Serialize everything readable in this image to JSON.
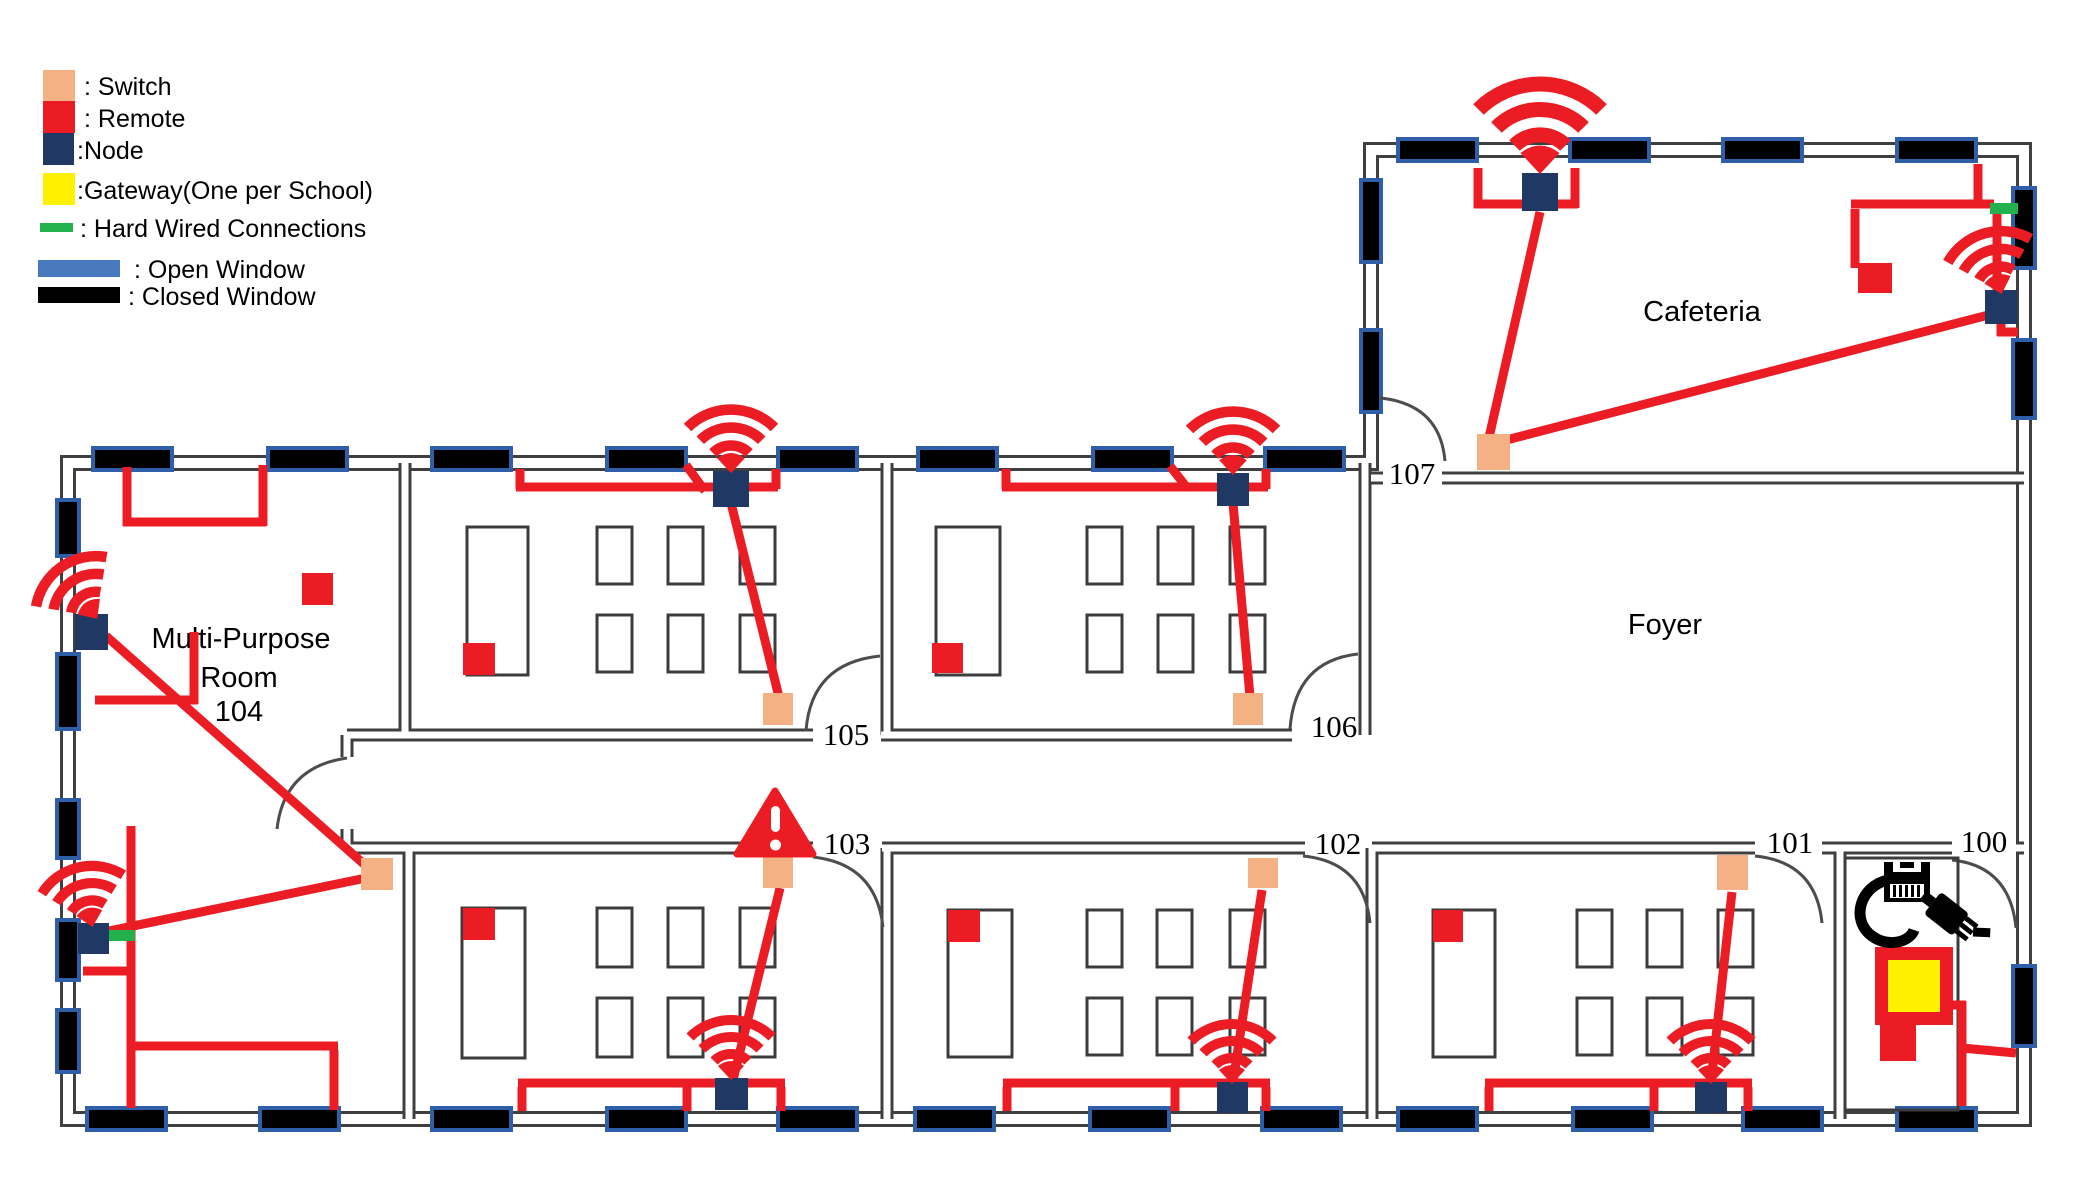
{
  "legend": {
    "switch_label": ": Switch",
    "remote_label": ": Remote",
    "node_label": ":Node",
    "gateway_label": ":Gateway(One per School)",
    "hardwired_label": ": Hard Wired Connections",
    "open_window_label": ": Open Window",
    "closed_window_label": ": Closed Window"
  },
  "rooms": {
    "multipurpose": {
      "line1": "Multi-Purpose",
      "line2": "Room",
      "line3": "104"
    },
    "r105": "105",
    "r106": "106",
    "r107": "107",
    "cafeteria": "Cafeteria",
    "foyer": "Foyer",
    "r103": "103",
    "r102": "102",
    "r101": "101",
    "r100": "100"
  },
  "colors": {
    "switch": "#F4B183",
    "remote": "#EC1C24",
    "node": "#1F3864",
    "gateway_fill": "#FFF100",
    "gateway_border": "#EC1C24",
    "hardwired": "#22B14C",
    "open_window": "#4878BE",
    "closed_window": "#000000",
    "window_border": "#2E5FA8",
    "wire": "#EC1C24",
    "wall": "#3F3F3F",
    "desk": "#3C3C3C"
  },
  "devices": {
    "switches": [
      "switch-cafeteria-107",
      "switch-room-104",
      "switch-room-105",
      "switch-room-106",
      "switch-room-103",
      "switch-room-102",
      "switch-room-101"
    ],
    "remotes": [
      "remote-cafeteria",
      "remote-room-104",
      "remote-room-105",
      "remote-room-106",
      "remote-room-103",
      "remote-room-102",
      "remote-room-101",
      "remote-room-100"
    ],
    "nodes": [
      "node-cafeteria-north",
      "node-cafeteria-east",
      "node-room-104-north",
      "node-room-104-south",
      "node-room-105",
      "node-room-106",
      "node-room-103",
      "node-room-102",
      "node-room-101"
    ],
    "gateways": [
      "gateway-room-100"
    ],
    "hardwired_connections": [
      "hardwired-cafeteria-east",
      "hardwired-room-104-south"
    ],
    "warnings": [
      "warning-room-103-switch"
    ]
  }
}
